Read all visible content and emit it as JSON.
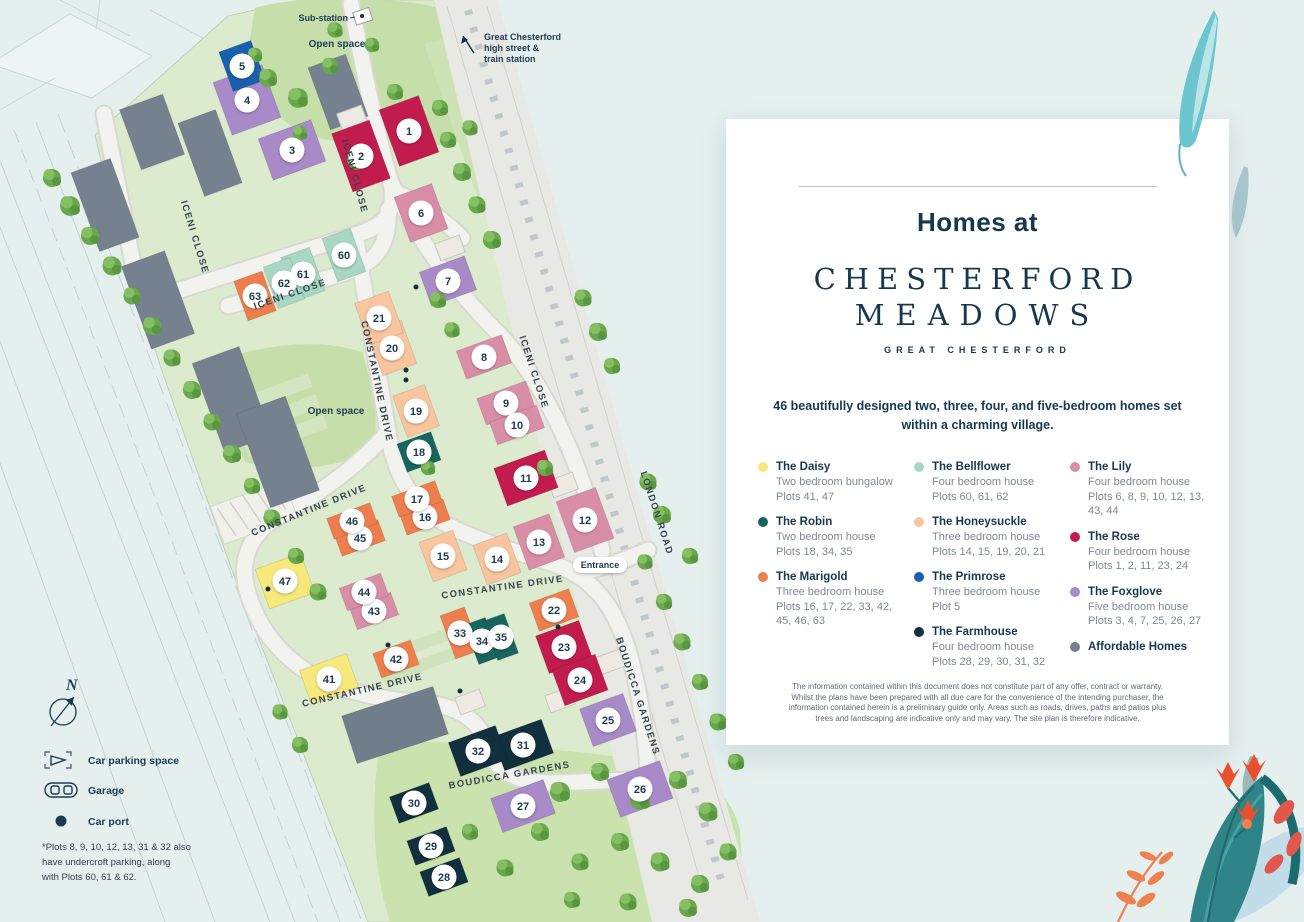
{
  "panel": {
    "heading": "Homes at",
    "brand_line1": "CHESTERFORD",
    "brand_line2": "MEADOWS",
    "brand_subtitle": "GREAT CHESTERFORD",
    "intro": "46 beautifully designed two, three, four, and five-bedroom homes set within a charming village.",
    "disclaimer": "The information contained within this document does not constitute part of any offer, contract or warranty. Whilst the plans have been prepared with all due care for the convenience of the intending purchaser, the information contained herein is a preliminary guide only. Areas such as roads, drives, paths and patios plus trees and landscaping are indicative only and may vary. The site plan is therefore indicative."
  },
  "house_types": [
    {
      "name": "The Daisy",
      "desc": "Two bedroom bungalow",
      "plots": "Plots 41, 47",
      "color": "#f7e87c"
    },
    {
      "name": "The Robin",
      "desc": "Two bedroom house",
      "plots": "Plots 18, 34, 35",
      "color": "#186560"
    },
    {
      "name": "The Marigold",
      "desc": "Three bedroom house",
      "plots": "Plots 16, 17, 22, 33, 42, 45, 46, 63",
      "color": "#ee7e4d"
    },
    {
      "name": "The Bellflower",
      "desc": "Four bedroom house",
      "plots": "Plots 60, 61, 62",
      "color": "#a8d7c4"
    },
    {
      "name": "The Honeysuckle",
      "desc": "Three bedroom house",
      "plots": "Plots 14, 15, 19, 20, 21",
      "color": "#f8c59e"
    },
    {
      "name": "The Primrose",
      "desc": "Three bedroom house",
      "plots": "Plot 5",
      "color": "#1a5fae"
    },
    {
      "name": "The Farmhouse",
      "desc": "Four bedroom house",
      "plots": "Plots 28, 29, 30, 31, 32",
      "color": "#122f3e"
    },
    {
      "name": "The Lily",
      "desc": "Four bedroom house",
      "plots": "Plots 6, 8, 9, 10, 12, 13, 43, 44",
      "color": "#d98ea7"
    },
    {
      "name": "The Rose",
      "desc": "Four bedroom house",
      "plots": "Plots 1, 2, 11, 23, 24",
      "color": "#c21b4d"
    },
    {
      "name": "The Foxglove",
      "desc": "Five bedroom house",
      "plots": "Plots 3, 4, 7, 25, 26, 27",
      "color": "#a78ac7"
    },
    {
      "name": "Affordable Homes",
      "desc": "",
      "plots": "",
      "color": "#75818e"
    }
  ],
  "legend_columns": [
    [
      0,
      1,
      2
    ],
    [
      3,
      4,
      5,
      6
    ],
    [
      7,
      8,
      9,
      10
    ]
  ],
  "map_key": {
    "parking_label": "Car parking space",
    "garage_label": "Garage",
    "carport_label": "Car port",
    "note_line1": "*Plots 8, 9, 10, 12, 13, 31 & 32 also",
    "note_line2": "have undercroft parking, along",
    "note_line3": "with Plots 60, 61 & 62.",
    "compass": "N"
  },
  "map": {
    "labels": {
      "substation": "Sub-station",
      "open_space_top": "Open space",
      "open_space_mid": "Open space",
      "entrance": "Entrance",
      "station_line1": "Great Chesterford",
      "station_line2": "high street &",
      "station_line3": "train station"
    },
    "streets": [
      {
        "t": "ICENI CLOSE",
        "x": 352,
        "y": 177,
        "r": 75
      },
      {
        "t": "ICENI CLOSE",
        "x": 192,
        "y": 238,
        "r": 73
      },
      {
        "t": "ICENI CLOSE",
        "x": 291,
        "y": 297,
        "r": -19
      },
      {
        "t": "ICENI CLOSE",
        "x": 531,
        "y": 373,
        "r": 72
      },
      {
        "t": "CONSTANTINE DRIVE",
        "x": 374,
        "y": 382,
        "r": 78
      },
      {
        "t": "CONSTANTINE DRIVE",
        "x": 310,
        "y": 513,
        "r": -22
      },
      {
        "t": "CONSTANTINE DRIVE",
        "x": 503,
        "y": 590,
        "r": -8
      },
      {
        "t": "CONSTANTINE DRIVE",
        "x": 363,
        "y": 693,
        "r": -13
      },
      {
        "t": "LONDON ROAD",
        "x": 654,
        "y": 514,
        "r": 72
      },
      {
        "t": "BOUDICCA GARDENS",
        "x": 635,
        "y": 697,
        "r": 72
      },
      {
        "t": "BOUDICCA GARDENS",
        "x": 510,
        "y": 778,
        "r": -10
      }
    ],
    "plots": [
      {
        "n": 1,
        "x": 409,
        "y": 131,
        "t": 8,
        "w": 42,
        "h": 60
      },
      {
        "n": 2,
        "x": 361,
        "y": 156,
        "t": 8,
        "w": 40,
        "h": 62
      },
      {
        "n": 3,
        "x": 292,
        "y": 150,
        "t": 9,
        "w": 56,
        "h": 44
      },
      {
        "n": 4,
        "x": 247,
        "y": 100,
        "t": 9,
        "w": 52,
        "h": 56
      },
      {
        "n": 5,
        "x": 242,
        "y": 66,
        "t": 5,
        "w": 34,
        "h": 42
      },
      {
        "n": 6,
        "x": 421,
        "y": 213,
        "t": 7,
        "w": 40,
        "h": 48
      },
      {
        "n": 7,
        "x": 448,
        "y": 281,
        "t": 9,
        "w": 48,
        "h": 36
      },
      {
        "n": 8,
        "x": 484,
        "y": 357,
        "t": 7,
        "w": 48,
        "h": 30
      },
      {
        "n": 9,
        "x": 506,
        "y": 403,
        "t": 7,
        "w": 52,
        "h": 28
      },
      {
        "n": 10,
        "x": 517,
        "y": 425,
        "t": 7,
        "w": 50,
        "h": 24
      },
      {
        "n": 11,
        "x": 526,
        "y": 478,
        "t": 8,
        "w": 54,
        "h": 40
      },
      {
        "n": 12,
        "x": 585,
        "y": 520,
        "t": 7,
        "w": 42,
        "h": 54
      },
      {
        "n": 13,
        "x": 539,
        "y": 542,
        "t": 7,
        "w": 38,
        "h": 46
      },
      {
        "n": 14,
        "x": 497,
        "y": 559,
        "t": 4,
        "w": 36,
        "h": 42
      },
      {
        "n": 15,
        "x": 443,
        "y": 556,
        "t": 4,
        "w": 36,
        "h": 42
      },
      {
        "n": 16,
        "x": 425,
        "y": 517,
        "t": 2,
        "w": 46,
        "h": 22
      },
      {
        "n": 17,
        "x": 417,
        "y": 499,
        "t": 2,
        "w": 46,
        "h": 22
      },
      {
        "n": 18,
        "x": 419,
        "y": 452,
        "t": 1,
        "w": 36,
        "h": 30
      },
      {
        "n": 19,
        "x": 416,
        "y": 411,
        "t": 4,
        "w": 34,
        "h": 44
      },
      {
        "n": 20,
        "x": 392,
        "y": 348,
        "t": 4,
        "w": 36,
        "h": 46
      },
      {
        "n": 21,
        "x": 379,
        "y": 318,
        "t": 4,
        "w": 36,
        "h": 44
      },
      {
        "n": 22,
        "x": 554,
        "y": 610,
        "t": 2,
        "w": 42,
        "h": 30
      },
      {
        "n": 23,
        "x": 564,
        "y": 647,
        "t": 8,
        "w": 46,
        "h": 40
      },
      {
        "n": 24,
        "x": 580,
        "y": 680,
        "t": 8,
        "w": 46,
        "h": 38
      },
      {
        "n": 25,
        "x": 608,
        "y": 720,
        "t": 9,
        "w": 46,
        "h": 40
      },
      {
        "n": 26,
        "x": 640,
        "y": 789,
        "t": 9,
        "w": 56,
        "h": 40
      },
      {
        "n": 27,
        "x": 523,
        "y": 806,
        "t": 9,
        "w": 56,
        "h": 36
      },
      {
        "n": 28,
        "x": 444,
        "y": 877,
        "t": 6,
        "w": 42,
        "h": 26
      },
      {
        "n": 29,
        "x": 431,
        "y": 846,
        "t": 6,
        "w": 42,
        "h": 26
      },
      {
        "n": 30,
        "x": 414,
        "y": 803,
        "t": 6,
        "w": 42,
        "h": 28
      },
      {
        "n": 31,
        "x": 523,
        "y": 745,
        "t": 6,
        "w": 52,
        "h": 36
      },
      {
        "n": 32,
        "x": 478,
        "y": 751,
        "t": 6,
        "w": 50,
        "h": 36
      },
      {
        "n": 33,
        "x": 460,
        "y": 633,
        "t": 2,
        "w": 26,
        "h": 46
      },
      {
        "n": 34,
        "x": 482,
        "y": 641,
        "t": 1,
        "w": 22,
        "h": 42
      },
      {
        "n": 35,
        "x": 501,
        "y": 637,
        "t": 1,
        "w": 22,
        "h": 42
      },
      {
        "n": 41,
        "x": 329,
        "y": 679,
        "t": 0,
        "w": 50,
        "h": 36
      },
      {
        "n": 42,
        "x": 396,
        "y": 659,
        "t": 2,
        "w": 40,
        "h": 26
      },
      {
        "n": 43,
        "x": 374,
        "y": 611,
        "t": 7,
        "w": 44,
        "h": 24
      },
      {
        "n": 44,
        "x": 364,
        "y": 592,
        "t": 7,
        "w": 44,
        "h": 24
      },
      {
        "n": 45,
        "x": 360,
        "y": 538,
        "t": 2,
        "w": 46,
        "h": 22
      },
      {
        "n": 46,
        "x": 352,
        "y": 521,
        "t": 2,
        "w": 46,
        "h": 22
      },
      {
        "n": 47,
        "x": 285,
        "y": 581,
        "t": 0,
        "w": 48,
        "h": 42
      },
      {
        "n": 60,
        "x": 344,
        "y": 255,
        "t": 3,
        "w": 30,
        "h": 46
      },
      {
        "n": 61,
        "x": 303,
        "y": 274,
        "t": 3,
        "w": 30,
        "h": 46
      },
      {
        "n": 62,
        "x": 284,
        "y": 283,
        "t": 3,
        "w": 28,
        "h": 44
      },
      {
        "n": 63,
        "x": 255,
        "y": 296,
        "t": 2,
        "w": 30,
        "h": 42
      }
    ]
  }
}
